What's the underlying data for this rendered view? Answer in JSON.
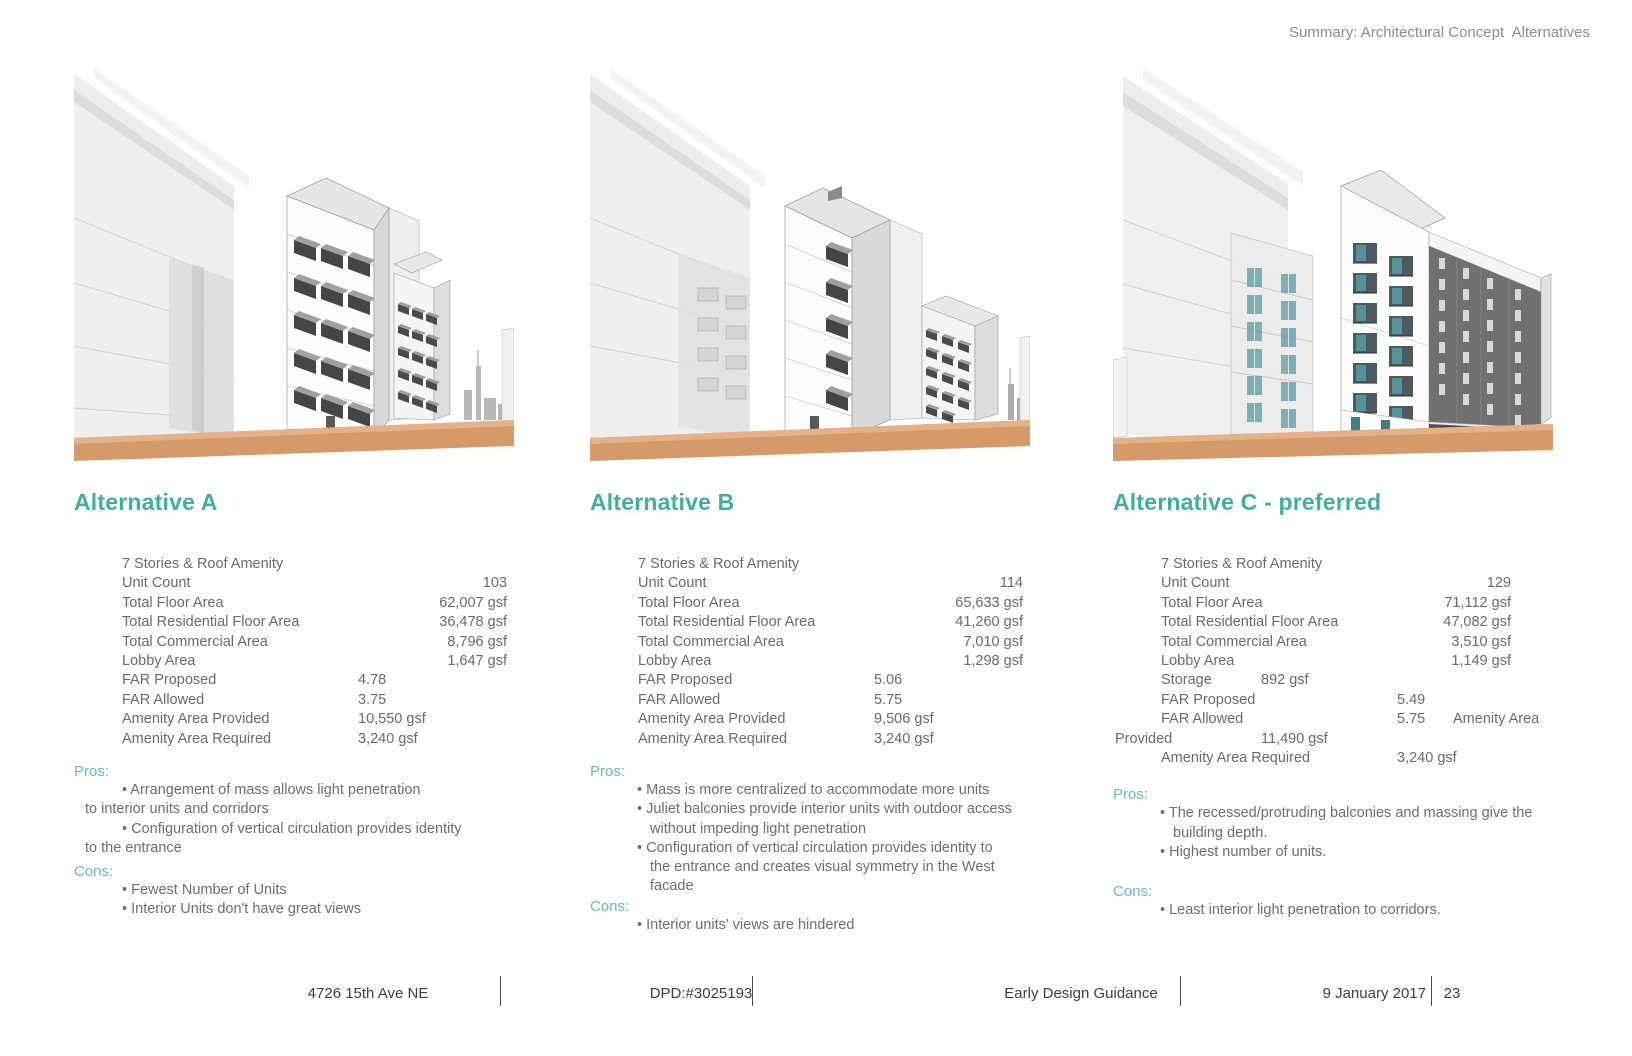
{
  "page": {
    "header": "Summary: Architectural Concept  Alternatives",
    "footer": {
      "address": "4726 15th Ave NE",
      "permit": "DPD:#3025193",
      "doc_title": "Early Design Guidance",
      "date": "9 January 2017",
      "page_number": "23"
    }
  },
  "colors": {
    "accent_teal": "#40b09c",
    "proscons_teal": "#6ab9c0",
    "ground_orange": "#d59a6a",
    "body_gray": "#6b6b6b"
  },
  "alternatives": [
    {
      "title": "Alternative A",
      "stats": [
        {
          "label": "7 Stories & Roof Amenity"
        },
        {
          "label": "Unit Count",
          "right": "103"
        },
        {
          "label": "Total Floor Area",
          "right": "62,007 gsf"
        },
        {
          "label": "Total Residential Floor Area",
          "right": "36,478 gsf"
        },
        {
          "label": "Total Commercial Area",
          "right": "8,796 gsf"
        },
        {
          "label": "Lobby Area",
          "right": "1,647 gsf"
        },
        {
          "label": "FAR Proposed",
          "mid": "4.78"
        },
        {
          "label": "FAR Allowed",
          "mid": "3.75"
        },
        {
          "label": "Amenity Area Provided",
          "mid": "10,550 gsf"
        },
        {
          "label": "Amenity Area Required",
          "mid": "3,240 gsf"
        }
      ],
      "pros_label": "Pros:",
      "cons_label": "Cons:",
      "pros": [
        "Arrangement of mass allows light penetration\nto interior units and corridors",
        "Configuration of vertical circulation provides identity\nto the entrance"
      ],
      "cons": [
        "Fewest Number of Units",
        "Interior Units don't have great views"
      ]
    },
    {
      "title": "Alternative B",
      "stats": [
        {
          "label": "7 Stories & Roof Amenity"
        },
        {
          "label": "Unit Count",
          "right": "114"
        },
        {
          "label": "Total Floor Area",
          "right": "65,633 gsf"
        },
        {
          "label": "Total Residential Floor Area",
          "right": "41,260 gsf"
        },
        {
          "label": "Total Commercial Area",
          "right": "7,010 gsf"
        },
        {
          "label": "Lobby Area",
          "right": "1,298 gsf"
        },
        {
          "label": "FAR Proposed",
          "mid": "5.06"
        },
        {
          "label": "FAR Allowed",
          "mid": "5.75"
        },
        {
          "label": "Amenity Area Provided",
          "mid": "9,506 gsf"
        },
        {
          "label": "Amenity Area Required",
          "mid": "3,240 gsf"
        }
      ],
      "pros_label": "Pros:",
      "cons_label": "Cons:",
      "pros": [
        "Mass is more centralized to accommodate more units",
        "Juliet balconies provide interior units with outdoor access\nwithout impeding light penetration",
        "Configuration of vertical circulation provides identity to\nthe entrance and creates visual symmetry in the West\nfacade"
      ],
      "cons": [
        "Interior units' views are hindered"
      ]
    },
    {
      "title": "Alternative C - preferred",
      "stats": [
        {
          "label": "7 Stories & Roof Amenity"
        },
        {
          "label": "Unit Count",
          "right": "129"
        },
        {
          "label": "Total Floor Area",
          "right": "71,112 gsf"
        },
        {
          "label": "Total Residential Floor Area",
          "right": "47,082 gsf"
        },
        {
          "label": "Total Commercial Area",
          "right": "3,510 gsf"
        },
        {
          "label": "Lobby Area",
          "right": "1,149 gsf"
        },
        {
          "label": "Storage",
          "mid2": "892 gsf"
        },
        {
          "label": "FAR Proposed",
          "mid": "5.49"
        },
        {
          "label": "FAR Allowed",
          "mid": "5.75",
          "extra": "Amenity Area"
        },
        {
          "label": "Provided",
          "mid2": "11,490 gsf",
          "outdent": true
        },
        {
          "label": "Amenity Area Required",
          "mid": "3,240 gsf"
        }
      ],
      "pros_label": "Pros:",
      "cons_label": "Cons:",
      "pros": [
        "The recessed/protruding balconies and massing give the\nbuilding depth.",
        "Highest number of units."
      ],
      "cons": [
        "Least interior light penetration to corridors."
      ]
    }
  ]
}
